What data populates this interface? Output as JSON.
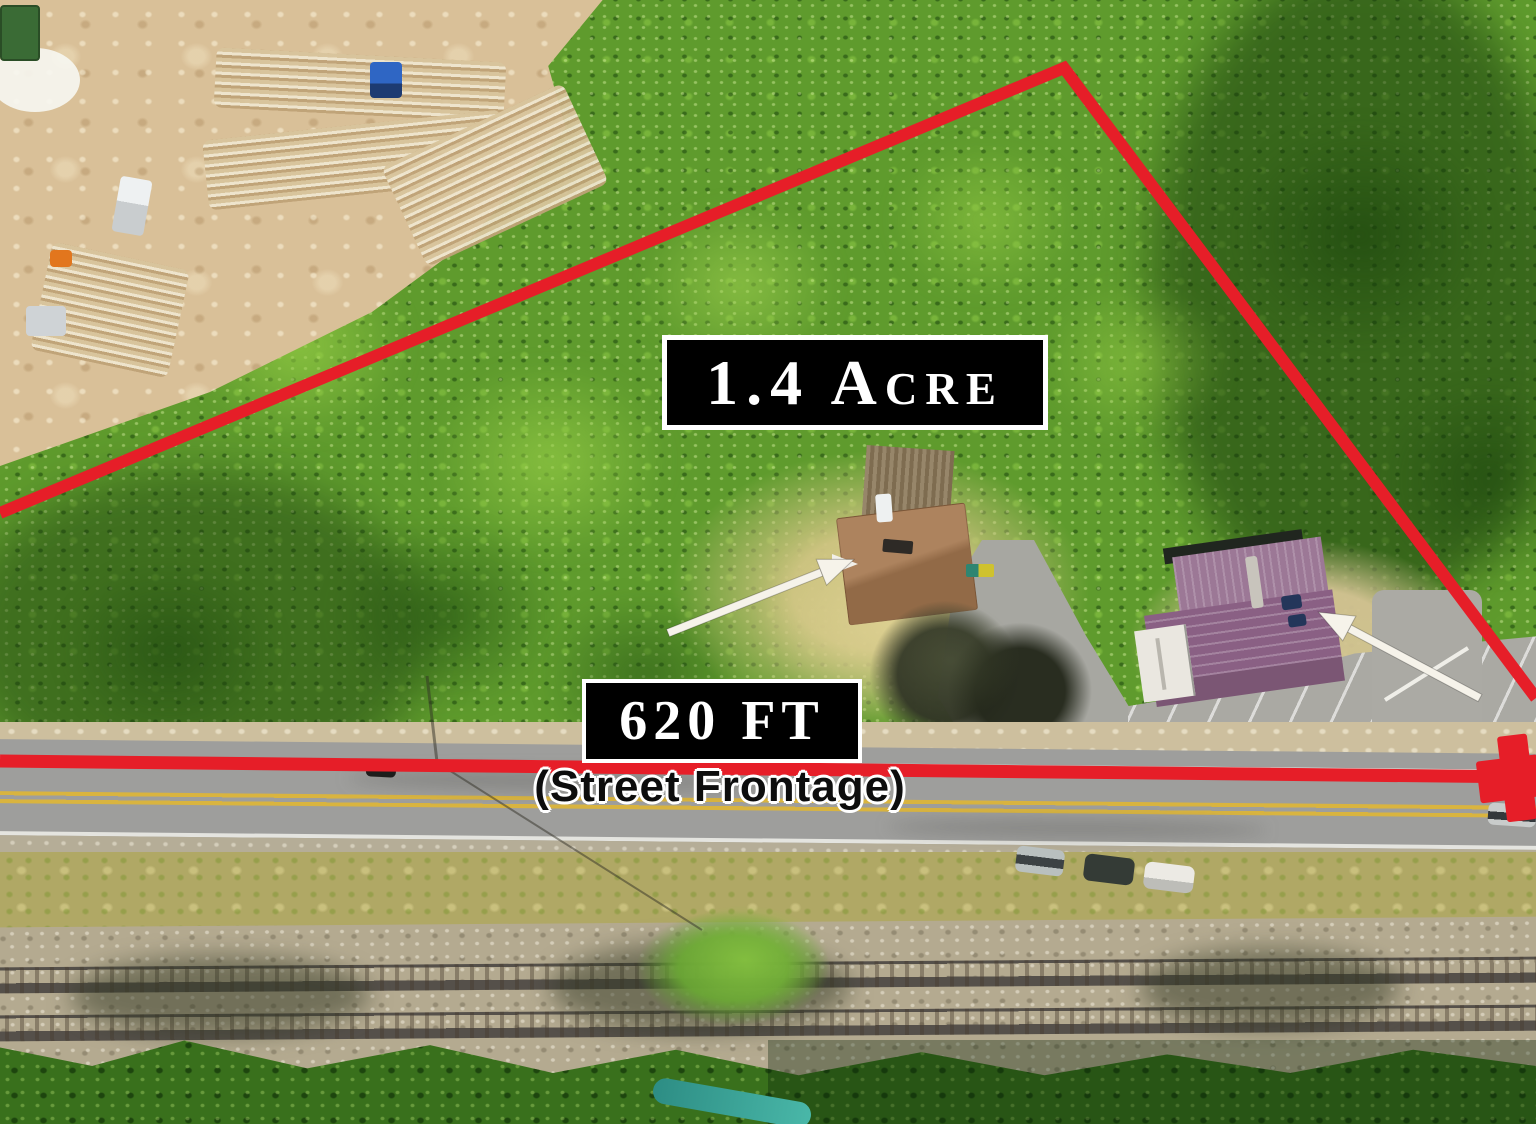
{
  "annotations": {
    "acreage_label": "1.4 Acre",
    "frontage_value": "620 FT",
    "frontage_caption": "(Street Frontage)"
  },
  "colors": {
    "boundary_red": "#e61e28",
    "label_background": "#000000",
    "label_text": "#ffffff",
    "label_border": "#ffffff",
    "caption_text": "#0d0d0d",
    "caption_outline": "#ffffff",
    "arrow_fill": "#f6f3ea"
  }
}
